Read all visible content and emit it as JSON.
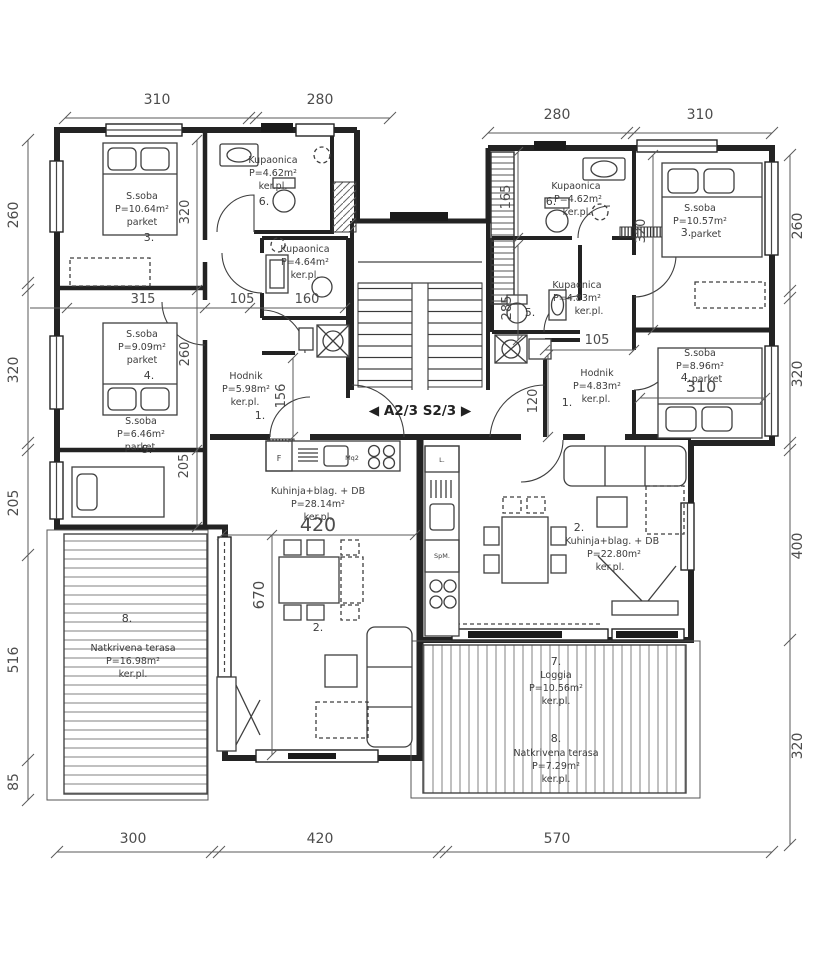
{
  "marker": {
    "direction_sign": "◀ A2/3    S2/3 ▶"
  },
  "apartments": {
    "left": {
      "bed3": {
        "name": "S.soba",
        "area": "P=10.64m²",
        "floor": "parket",
        "num": "3."
      },
      "bath6": {
        "name": "Kupaonica",
        "area": "P=4.62m²",
        "floor": "ker.pl.",
        "num": "6."
      },
      "bath7": {
        "name": "Kupaonica",
        "area": "P=4.64m²",
        "floor": "ker.pl."
      },
      "bed4": {
        "name": "S.soba",
        "area": "P=9.09m²",
        "floor": "parket",
        "num": "4."
      },
      "bed5": {
        "name": "S.soba",
        "area": "P=6.46m²",
        "floor": "parket",
        "num": "5."
      },
      "hodnik": {
        "name": "Hodnik",
        "area": "P=5.98m²",
        "floor": "ker.pl.",
        "num": "1."
      },
      "kitchen": {
        "name": "Kuhinja+blag.  +  DB",
        "area": "P=28.14m²",
        "floor": "ker.pl.",
        "num": "2."
      },
      "terrace": {
        "num": "8.",
        "name": "Natkrivena terasa",
        "area": "P=16.98m²",
        "floor": "ker.pl."
      }
    },
    "right": {
      "bath6": {
        "name": "Kupaonica",
        "area": "P=4.62m²",
        "floor": "ker.pl.",
        "num": "6."
      },
      "bed3": {
        "name": "S.soba",
        "area": "P=10.57m²",
        "floor": "parket",
        "num": "3."
      },
      "bath5": {
        "name": "Kupaonica",
        "area": "P=4.83m²",
        "floor": "ker.pl.",
        "num": "5."
      },
      "bed4": {
        "name": "S.soba",
        "area": "P=8.96m²",
        "floor": "parket",
        "num": "4."
      },
      "hodnik": {
        "name": "Hodnik",
        "area": "P=4.83m²",
        "floor": "ker.pl.",
        "num": "1."
      },
      "kitchen": {
        "num": "2.",
        "name": "Kuhinja+blag.  +  DB",
        "area": "P=22.80m²",
        "floor": "ker.pl."
      },
      "loggia": {
        "num": "7.",
        "name": "Loggia",
        "area": "P=10.56m²",
        "floor": "ker.pl."
      },
      "terrace": {
        "num": "8.",
        "name": "Natkrivena terasa",
        "area": "P=7.29m²",
        "floor": "ker.pl."
      }
    }
  },
  "appliances": {
    "left_fridge": "F",
    "left_washer": "Mq2",
    "right_top": "L.",
    "right_dishwasher": "SpM."
  },
  "dims": {
    "top_left": [
      "310",
      "280"
    ],
    "top_right": [
      "280",
      "310"
    ],
    "bottom": [
      "300",
      "420",
      "570"
    ],
    "left": [
      "260",
      "320",
      "205",
      "516",
      "85"
    ],
    "right": [
      "260",
      "320",
      "400",
      "320"
    ],
    "inner_left": {
      "v320": "320",
      "h315": "315",
      "h105": "105",
      "h160": "160",
      "v260": "260",
      "v156": "156",
      "v205": "205",
      "h420": "420",
      "v670": "670"
    },
    "inner_right": {
      "v165": "165",
      "v320": "320",
      "v285": "285",
      "h105": "105",
      "h310": "310",
      "v120": "120"
    }
  }
}
